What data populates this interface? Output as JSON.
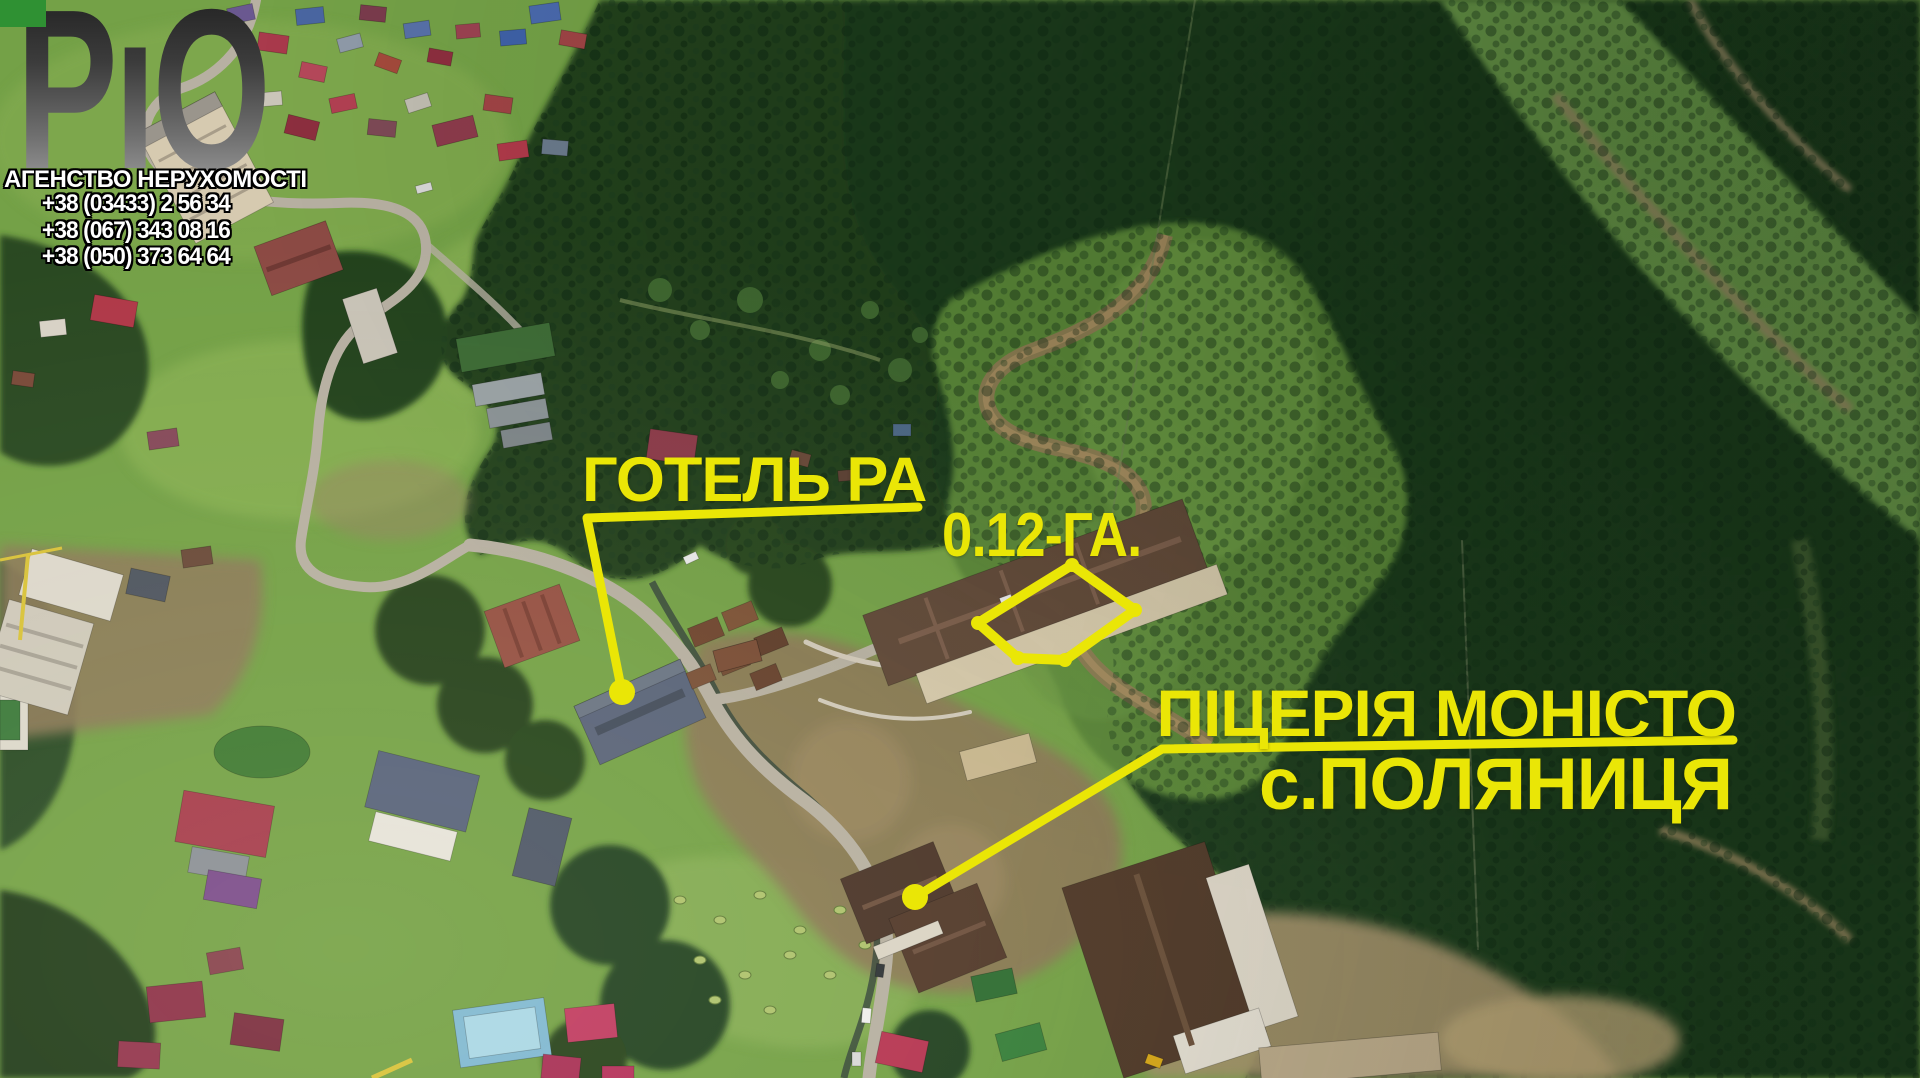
{
  "agency_branding": {
    "logo_text": "РіО",
    "logo_display_letters": [
      "Р",
      "ı",
      "О"
    ],
    "logo_dot_color": "#2f9133",
    "agency_name": "АГЕНСТВО НЕРУХОМОСТІ",
    "phones": [
      "+38 (03433) 2 56 34",
      "+38 (067) 343 08 16",
      "+38 (050) 373 64 64"
    ]
  },
  "annotations": {
    "accent_color": "#eae606",
    "hotel_label": "ГОТЕЛЬ РА",
    "plot_area_label": "0.12-ГА.",
    "pizzeria_label": "ПІЦЕРІЯ МОНІСТО",
    "village_label": "с.ПОЛЯНИЦЯ"
  }
}
